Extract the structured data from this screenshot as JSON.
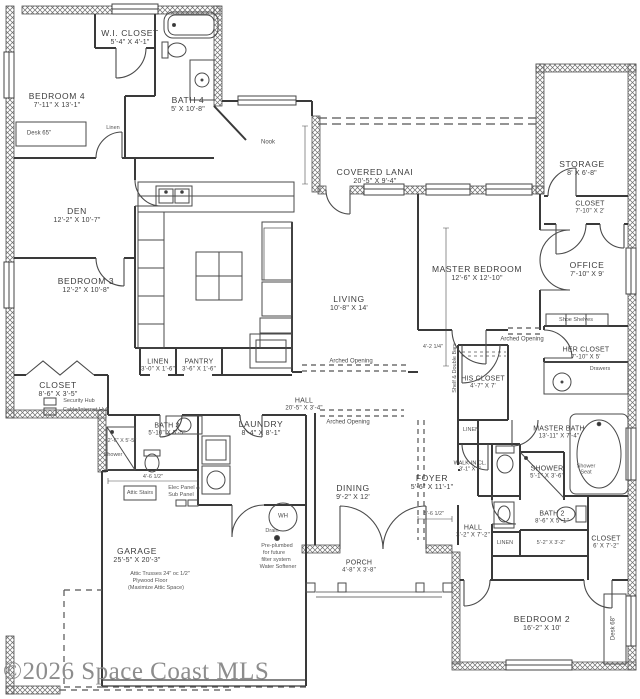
{
  "watermark": "©2026 Space Coast MLS",
  "rooms": {
    "wi_closet": {
      "name": "W.I. CLOSET",
      "dims": "5'-4\" X 4'-1\""
    },
    "bedroom4": {
      "name": "BEDROOM 4",
      "dims": "7'-11\" X 13'-1\""
    },
    "bath4": {
      "name": "BATH 4",
      "dims": "5' X 10'-8\""
    },
    "den": {
      "name": "DEN",
      "dims": "12'-2\" X 10'-7\""
    },
    "bedroom3": {
      "name": "BEDROOM 3",
      "dims": "12'-2\" X 10'-8\""
    },
    "covered_lanai": {
      "name": "COVERED LANAI",
      "dims": "20'-5\" X 9'-4\""
    },
    "storage": {
      "name": "STORAGE",
      "dims": "8' X 6'-8\""
    },
    "closet_ne": {
      "name": "CLOSET",
      "dims": "7'-10\" X 2'"
    },
    "master_bedroom": {
      "name": "MASTER BEDROOM",
      "dims": "12'-6\" X 12'-10\""
    },
    "office": {
      "name": "OFFICE",
      "dims": "7'-10\" X 9'"
    },
    "living": {
      "name": "LIVING",
      "dims": "10'-8\" X 14'"
    },
    "closet_w": {
      "name": "CLOSET",
      "dims": "8'-6\" X 3'-5\""
    },
    "linen_c": {
      "name": "LINEN",
      "dims": "3'-0\" X 1'-6\""
    },
    "pantry": {
      "name": "PANTRY",
      "dims": "3'-6\" X 1'-6\""
    },
    "hall_c": {
      "name": "HALL",
      "dims": "20'-5\" X 3'-4\""
    },
    "bath3": {
      "name": "BATH 3",
      "dims": "5'-10\" X 5'-5\""
    },
    "laundry": {
      "name": "LAUNDRY",
      "dims": "8'-4\" X 8'-1\""
    },
    "dining": {
      "name": "DINING",
      "dims": "9'-2\" X 12'"
    },
    "foyer": {
      "name": "FOYER",
      "dims": "5'-6\" X 11'-1\""
    },
    "his_closet": {
      "name": "HIS CLOSET",
      "dims": "4'-7\" X 7'"
    },
    "her_closet": {
      "name": "HER CLOSET",
      "dims": "7'-10\" X 5'"
    },
    "master_bath": {
      "name": "MASTER BATH",
      "dims": "13'-11\" X 7'-4\""
    },
    "shower_m": {
      "name": "SHOWER",
      "dims": "5'-1\" X 3'-6\""
    },
    "bath2": {
      "name": "BATH 2",
      "dims": "8'-6\" X 5'-1\""
    },
    "hall_e": {
      "name": "HALL",
      "dims": "3'-2\" X 7'-2\""
    },
    "closet_se": {
      "name": "CLOSET",
      "dims": "6' X 7'-2\""
    },
    "bedroom2": {
      "name": "BEDROOM 2",
      "dims": "16'-2\" X 10'"
    },
    "garage": {
      "name": "GARAGE",
      "dims": "25'-5\" X 20'-3\""
    },
    "porch": {
      "name": "PORCH",
      "dims": "4'-8\" X 3'-8\""
    },
    "walkin_cl": {
      "name": "WALK-IN CL.",
      "dims": "3'-1\" X 7'"
    }
  },
  "ann": {
    "nook": "Nook",
    "desk65": "Desk 65\"",
    "desk68": "Desk 68\"",
    "linen_b4": "Linen",
    "arched1": "Arched Opening",
    "arched2": "Arched Opening",
    "arched3": "Arched Opening",
    "shoe_shelves": "Shoe Shelves",
    "drawers": "Drawers",
    "shelf_bars": "Shelf & Double Bars",
    "linen_his": "LINEN",
    "linen_hall": "LINEN",
    "shower_seat": "Shower Seat",
    "shower_b3": "Shower",
    "dim_b3_shower": "2'-6\" X 5'-5\"",
    "dim_bath2": "5'-2\" X 3'-2\"",
    "security_hub": "Security Hub",
    "cable_hub": "Cable/Internet Hub",
    "attic_stairs": "Attic Stairs",
    "elec1": "Elec Panel &",
    "elec2": "Sub Panel",
    "wh": "WH",
    "drain": "Drain",
    "preplumbed1": "Pre-plumbed",
    "preplumbed2": "for future",
    "preplumbed3": "filter system",
    "preplumbed4": "Water Softener",
    "attic_note1": "Attic Trusses 24\" oc 1/2\"",
    "attic_note2": "Plywood Floor",
    "attic_note3": "(Maximize Attic Space)",
    "dim_4_6": "4'-6 1/2\"",
    "dim_5_6": "5'-6 1/2\"",
    "dim_4_2": "4'-2 1/4\""
  }
}
